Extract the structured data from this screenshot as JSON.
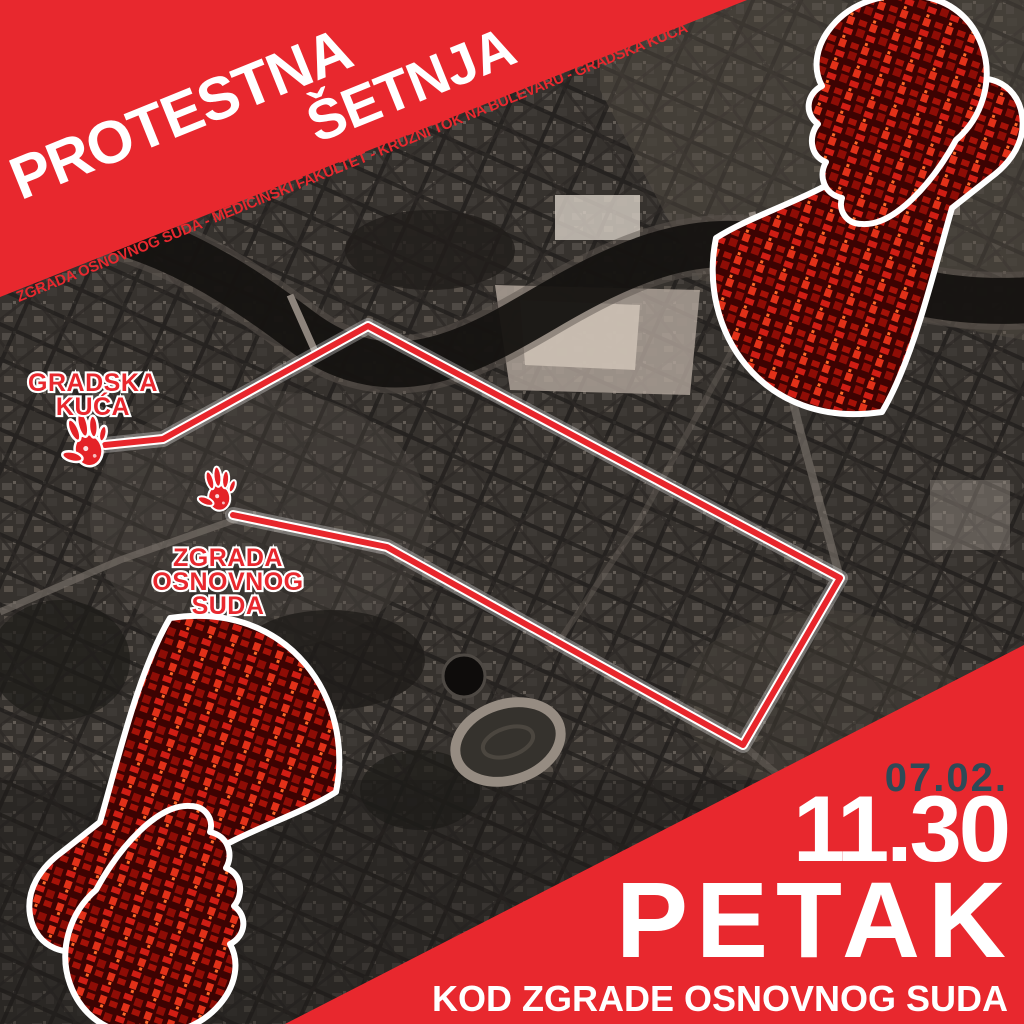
{
  "poster": {
    "title_line1": "PROTESTNA",
    "title_line2": "ŠETNJA",
    "route_summary": "ZGRADA OSNOVNOG SUDA - MEDICINSKI FAKULTET - KRUŽNI TOK NA BULEVARU - GRADSKA KUĆA",
    "event": {
      "date": "07.02.",
      "time": "11.30",
      "day": "PETAK",
      "location": "KOD ZGRADE OSNOVNOG SUDA"
    }
  },
  "map_labels": {
    "gradska_kuca": {
      "lines": [
        "GRADSKA",
        "KUĆA"
      ]
    },
    "zgrada_osnovnog_suda": {
      "lines": [
        "ZGRADA",
        "OSNOVNOG",
        "SUDA"
      ]
    }
  },
  "route": {
    "points": "105,445 163,439 368,326 840,578 743,745 387,547 233,515",
    "color": "#e8262c",
    "casing_color": "#ffffff"
  },
  "icons": {
    "megaphone_top_right": "megaphone-icon",
    "megaphone_bottom_left": "megaphone-icon",
    "handprint_start": "handprint-icon",
    "handprint_end": "handprint-icon"
  },
  "colors": {
    "accent_red": "#e8282e",
    "date_teal": "#2e4a57",
    "text_white": "#ffffff",
    "map_dark": "#2e2b28"
  }
}
